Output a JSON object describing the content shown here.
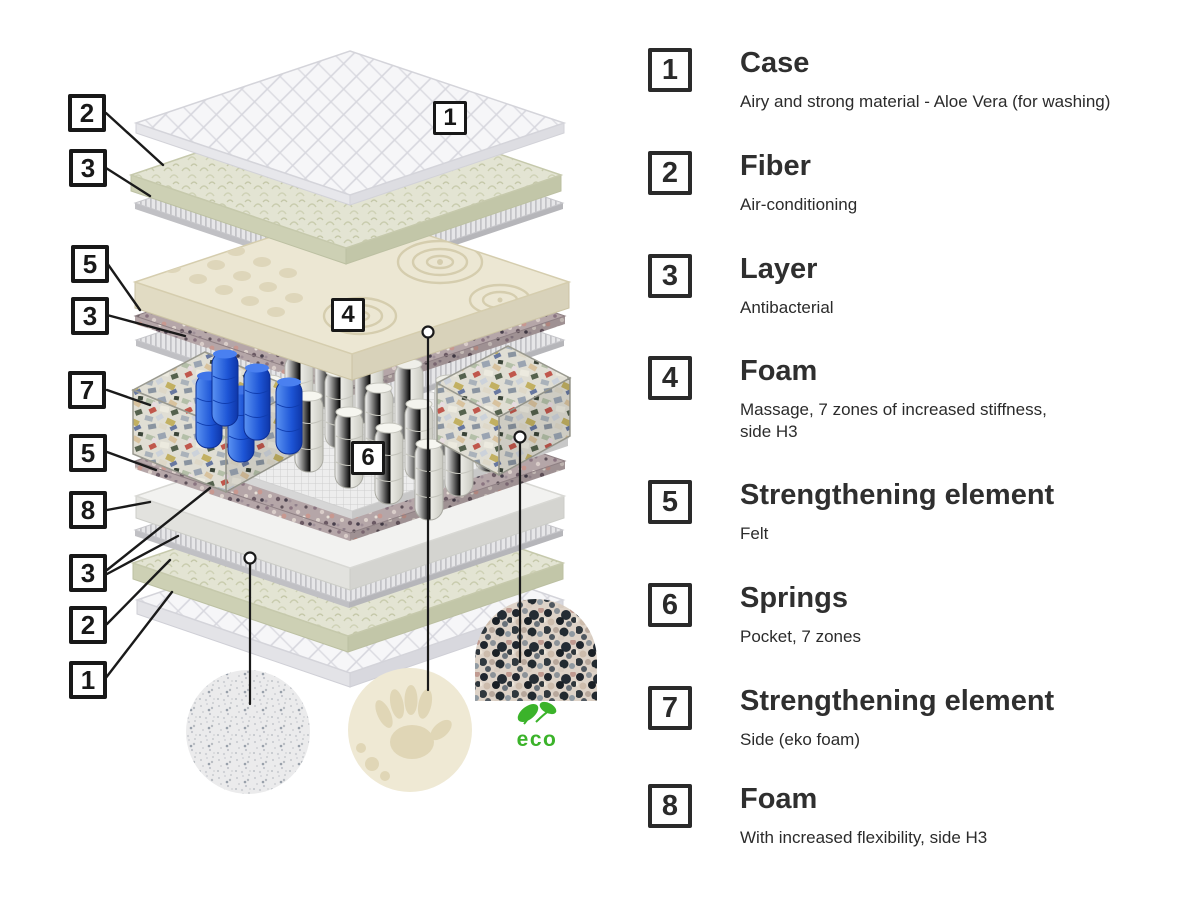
{
  "diagram": {
    "callouts_left": [
      "2",
      "3",
      "5",
      "3",
      "7",
      "5",
      "8",
      "3",
      "2",
      "1"
    ],
    "callouts_inner": [
      "1",
      "4",
      "6"
    ],
    "eco_label": "eco"
  },
  "legend": {
    "items": [
      {
        "number": "1",
        "title": "Case",
        "description": "Airy and strong material - Aloe Vera (for washing)"
      },
      {
        "number": "2",
        "title": "Fiber",
        "description": "Air-conditioning"
      },
      {
        "number": "3",
        "title": "Layer",
        "description": "Antibacterial"
      },
      {
        "number": "4",
        "title": "Foam",
        "description": "Massage, 7 zones of increased stiffness,\nside H3"
      },
      {
        "number": "5",
        "title": "Strengthening element",
        "description": "Felt"
      },
      {
        "number": "6",
        "title": "Springs",
        "description": "Pocket, 7 zones"
      },
      {
        "number": "7",
        "title": "Strengthening element",
        "description": "Side (eko foam)"
      },
      {
        "number": "8",
        "title": "Foam",
        "description": "With increased flexibility, side H3"
      }
    ]
  },
  "colors": {
    "accent_eco_green": "#3bb32a",
    "callout_border": "#181818",
    "blue_springs": "#1d55d6",
    "foam_cream": "#ece7d3"
  }
}
